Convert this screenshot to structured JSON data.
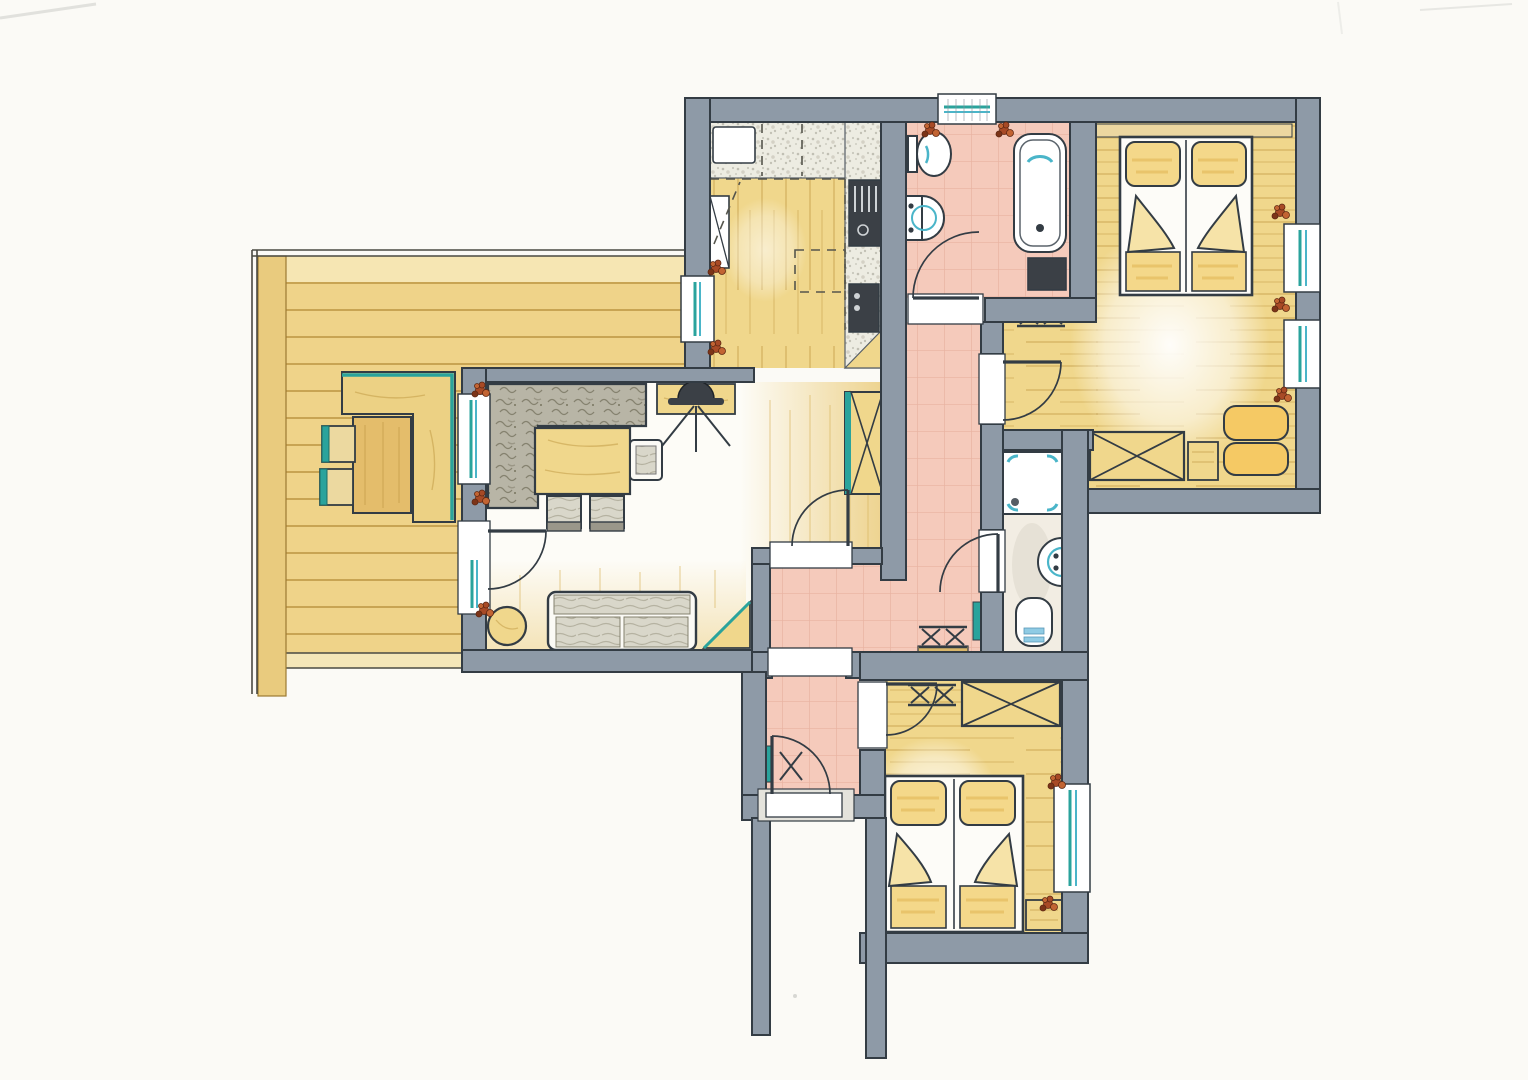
{
  "palette": {
    "paper": "#fbfaf6",
    "wall": "#8e9aa7",
    "ink": "#333c44",
    "wood": "#f0d78c",
    "wood_light": "#f7e9bd",
    "wood_dark": "#e4bd6b",
    "wood_line": "#c39c47",
    "deck": "#efd389",
    "tile": "#f5cabb",
    "tile_line": "#dd9e8a",
    "teal": "#2aa39c",
    "glass": "#4ab5c9",
    "counter": "#edece2",
    "speckle": "#b9b8ab",
    "gray_tex": "#b8b5a6",
    "cushion_gray": "#d9d7ca",
    "chair_gray": "#b5b2a3",
    "appliance": "#3b4046",
    "bed_yellow": "#f4d88a",
    "cushion_yellow": "#f5c964",
    "water": "#8fcbe4",
    "plant": "#a84a26",
    "plant_dark": "#7c3418"
  },
  "rooms": [
    {
      "id": "terrace"
    },
    {
      "id": "living-room"
    },
    {
      "id": "kitchen"
    },
    {
      "id": "bathroom"
    },
    {
      "id": "hallway"
    },
    {
      "id": "shower-room"
    },
    {
      "id": "bedroom-top"
    },
    {
      "id": "small-hall"
    },
    {
      "id": "entry-vestibule"
    },
    {
      "id": "bedroom-bottom"
    },
    {
      "id": "entrance-passage"
    }
  ],
  "symbols": [
    "double-bed-icon",
    "pillow-icon",
    "wardrobe-icon",
    "dresser-icon",
    "bench-cushion-icon",
    "luggage-rack-icon",
    "wall-shelf-icon",
    "sofa-icon",
    "corner-sofa-icon",
    "dining-table-icon",
    "chair-icon",
    "tv-icon",
    "tv-board-icon",
    "tall-cabinet-icon",
    "side-table-icon",
    "corner-shelf-icon",
    "kitchen-counter-icon",
    "kitchen-sink-icon",
    "cooktop-icon",
    "oven-icon",
    "fridge-icon",
    "planned-island-icon",
    "bathtub-icon",
    "toilet-icon",
    "washbasin-icon",
    "washing-machine-icon",
    "shower-tray-icon",
    "coat-rack-icon",
    "shoe-rack-icon",
    "radiator-icon",
    "door-arc-icon",
    "window-icon",
    "plant-icon",
    "terrace-bench-icon",
    "terrace-table-icon",
    "terrace-chair-icon"
  ]
}
